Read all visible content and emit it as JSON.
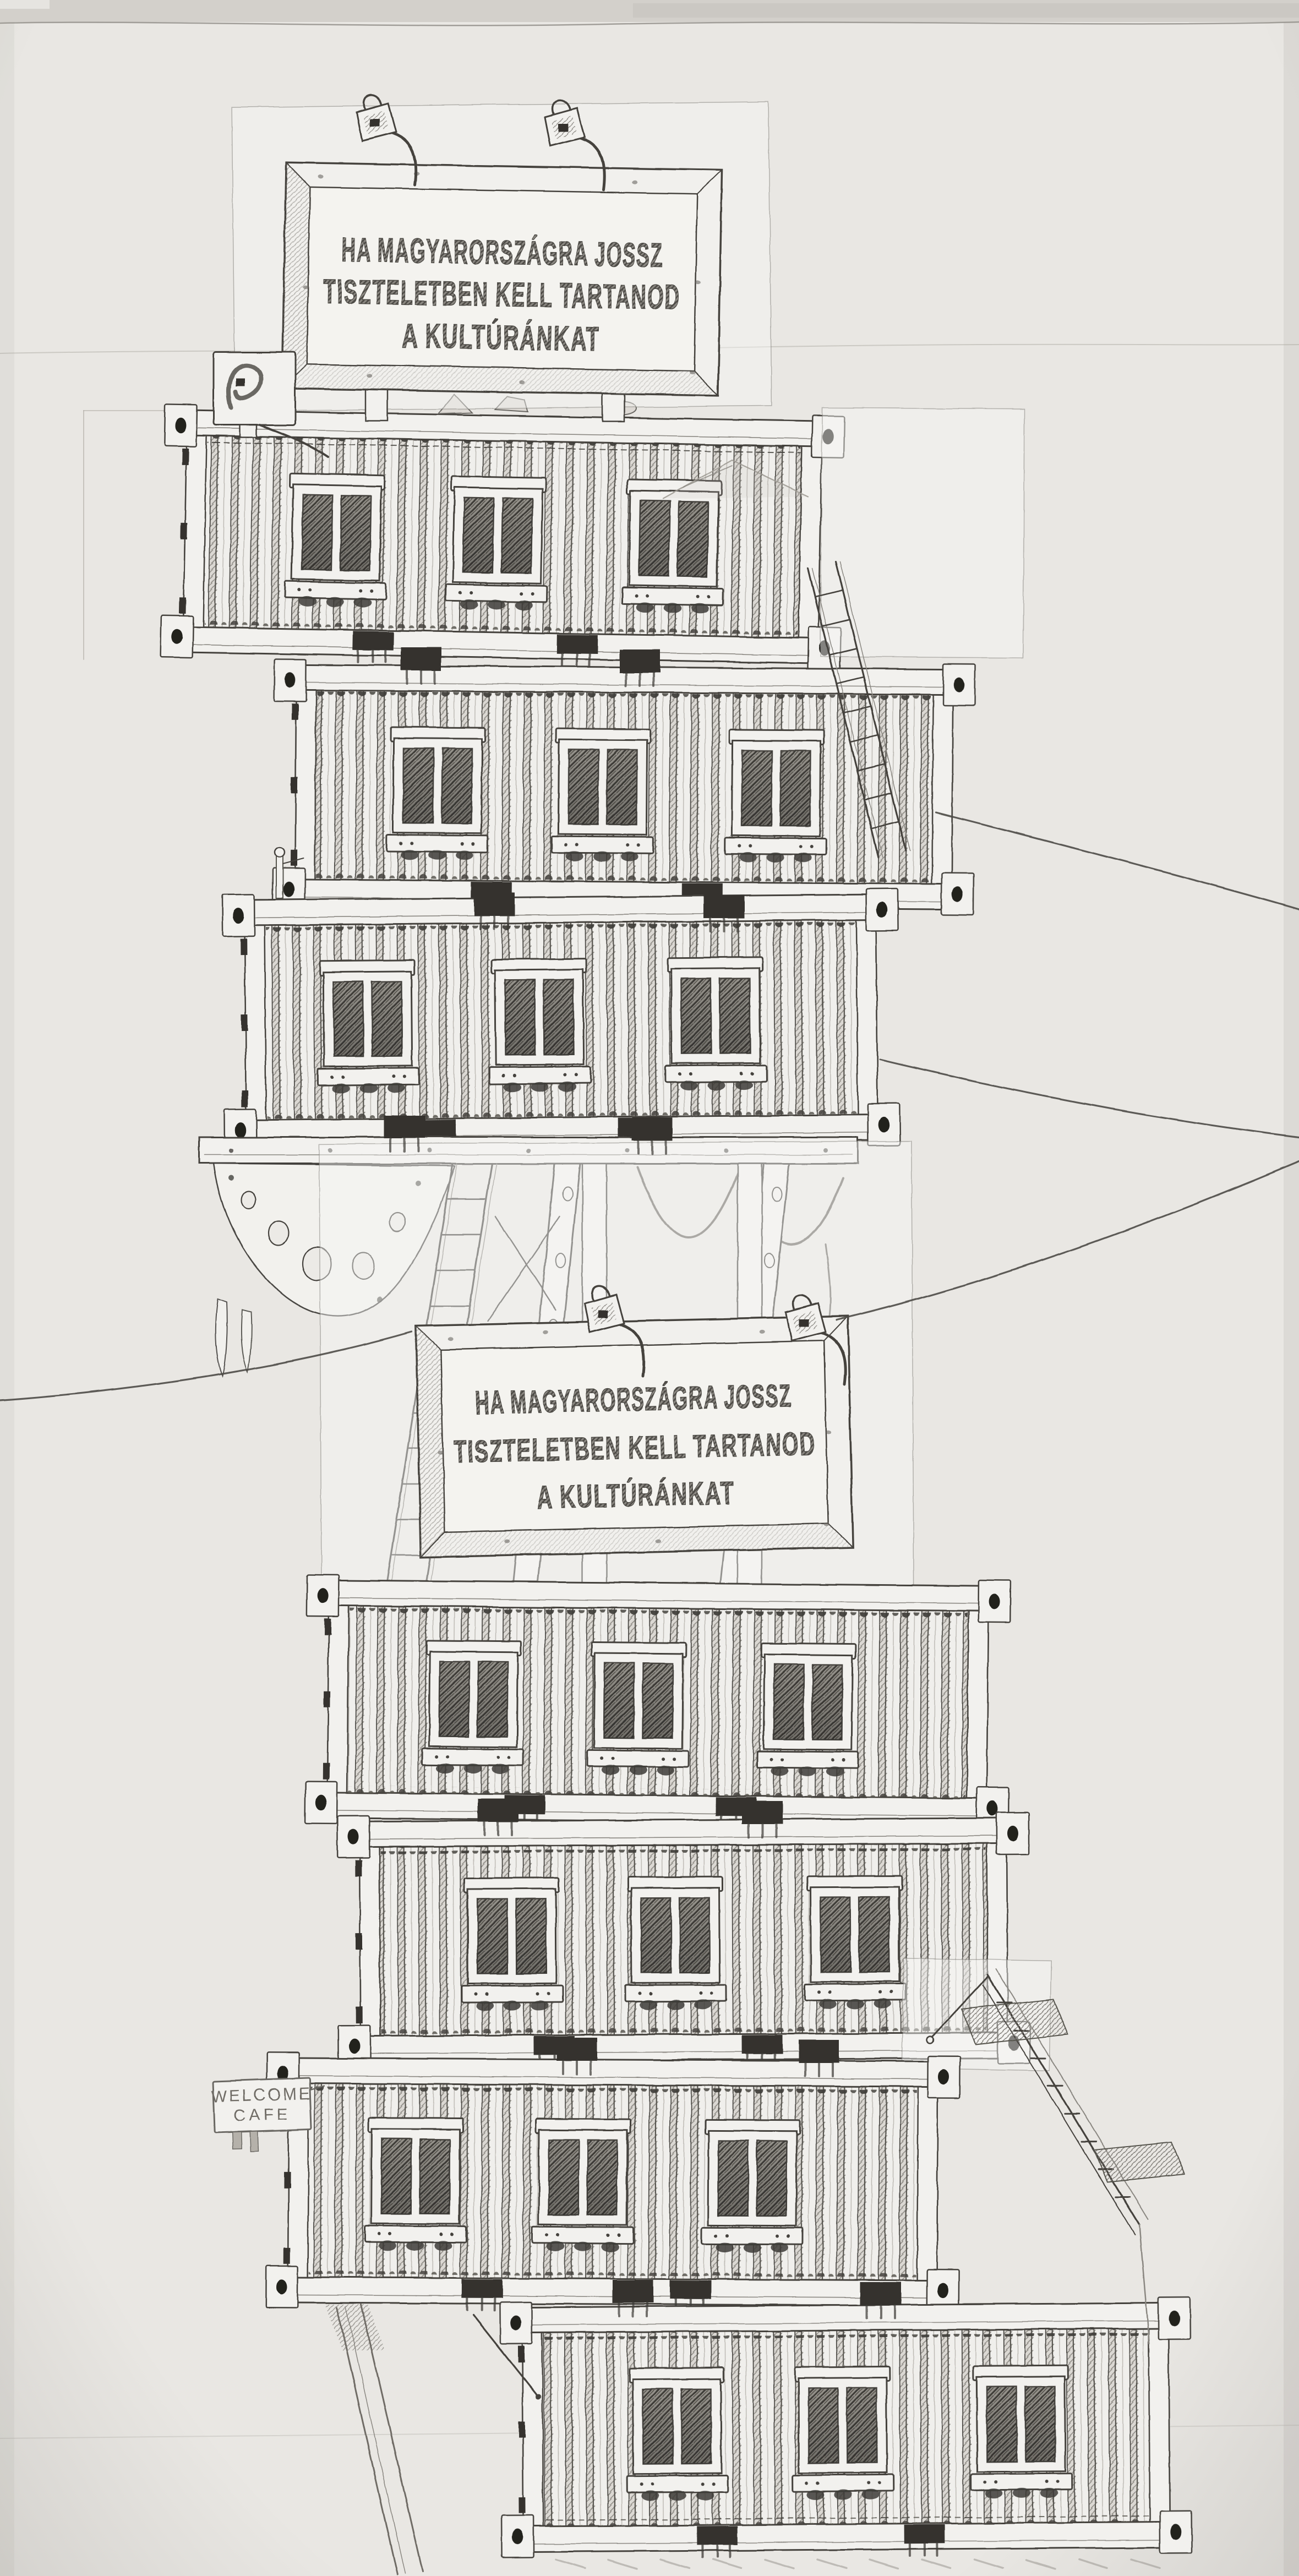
{
  "scene": {
    "medium": "pencil and ink drawing on paper",
    "subject": "Tower of stacked portable-cabin shipping containers on trestle legs, with two billboards, ladders, stairs and power wires",
    "container_count": 7
  },
  "billboard_top": {
    "lines": [
      "HA MAGYARORSZÁGRA JOSSZ",
      "TISZTELETBEN KELL TARTANOD",
      "A KULTÚRÁNKAT"
    ]
  },
  "billboard_middle": {
    "lines": [
      "HA MAGYARORSZÁGRA JOSSZ",
      "TISZTELETBEN KELL TARTANOD",
      "A KULTÚRÁNKAT"
    ]
  },
  "welcome_sign": {
    "lines": [
      "WELCOME",
      "CAFE"
    ]
  },
  "containers": [
    {
      "id": "container-1",
      "windows": 3
    },
    {
      "id": "container-2",
      "windows": 3
    },
    {
      "id": "container-3",
      "windows": 3
    },
    {
      "id": "container-4",
      "windows": 3
    },
    {
      "id": "container-5",
      "windows": 3
    },
    {
      "id": "container-6",
      "windows": 3
    },
    {
      "id": "container-7",
      "windows": 3
    }
  ],
  "colors": {
    "paper": "#e9e7e3",
    "paper_light": "#f2f1ee",
    "ink": "#44423e",
    "pencil": "#8a8781",
    "glass_dark": "#3d3b37",
    "vent_dark": "#34322e",
    "top_band": "#d3d0cb"
  }
}
